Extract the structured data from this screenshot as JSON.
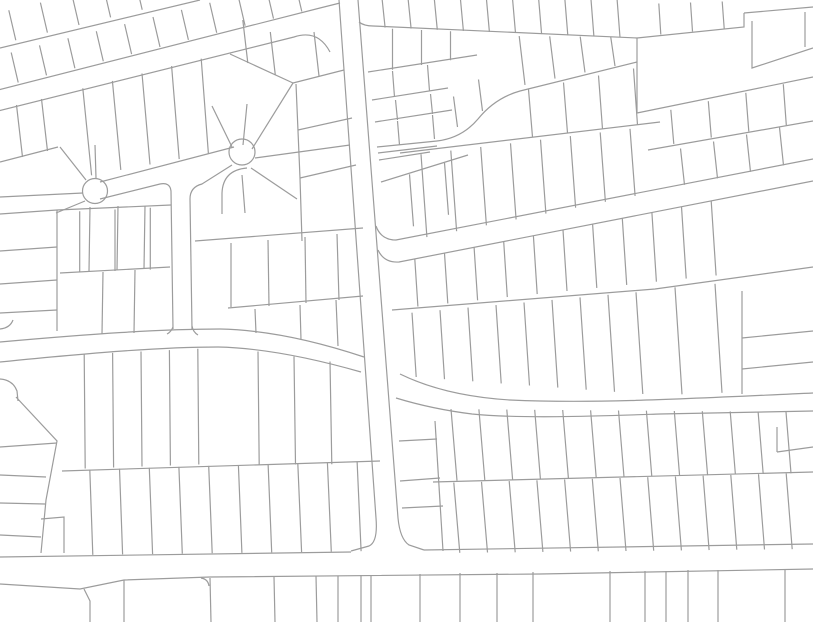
{
  "meta": {
    "description": "Cadastral parcel map viewport: white background with thin gray lot and street lines, cul-de-sac with two bulbs upper left, tilted vertical road in center, curving east-west road mid-left, diagonal roads upper-left and right, horizontal road along the bottom",
    "canvas": {
      "width": 813,
      "height": 622
    },
    "background": "#ffffff",
    "stroke": {
      "color": "#9c9c9c",
      "width": 1.2
    }
  },
  "map": {
    "circles": [
      {
        "cx": 95,
        "cy": 191,
        "r": 12.5,
        "name": "cul-de-sac-bulb-west"
      },
      {
        "cx": 242,
        "cy": 152,
        "r": 13,
        "name": "cul-de-sac-bulb-east"
      }
    ],
    "paths": [
      "M -2,90 L 320,8 L 340,3",
      "M -2,111 L 294,37 Q 318,29 330,52",
      "M 339,0 L 376,518 Q 378,542 369,546 L 351,551",
      "M 358,0 L 398,518 Q 400,539 409,545 L 424,550",
      "M 0,557 L 351,552",
      "M 424,550 L 813,544",
      "M 0,584 L 80,589 L 124,580 L 210,577 L 540,574 L 813,569",
      "M 84,589 L 90,601 L 90,622",
      "M 0,342 C 90,334 160,329 220,329 C 270,330 322,343 364,357",
      "M 0,362 C 90,353 160,347 218,347 C 264,348 312,358 361,372",
      "M 0,329 Q 10,328 13,320",
      "M 0,379 Q 13,380 17,391 L 18,401",
      "M 400,374 Q 445,396 510,400 C 600,404 700,398 813,393",
      "M 396,398 Q 432,409 472,414 C 522,419 600,416 660,414 L 813,411",
      "M 376,226 Q 381,240 396,240 L 813,159",
      "M 378,250 Q 384,263 399,262 L 813,181",
      "M 100,182 L 234,147",
      "M 100,199 L 160,184 Q 170,182 171,191 L 173,329",
      "M 192,329 L 190,199 Q 190,187 202,184 L 232,165",
      "M 167,334 Q 171,332 173,327",
      "M 192,326 Q 193,332 198,335",
      "M 247,168 Q 223,170 222,193 L 222,214",
      "M 86,180 L 60,147",
      "M 96,178 L 95,145",
      "M 83,193 L 0,197",
      "M 85,201 L 56,213",
      "M 232,147 L 212,106",
      "M 243,145 L 247,104",
      "M 252,149 L 293,83",
      "M 255,158 L 350,145",
      "M 251,168 L 297,199",
      "M 242,175 L 245,213",
      "M 0,48 L 200,0",
      "M 0,162 L 58,147",
      "M 230,54 L 293,83",
      "M 293,83 L 344,70",
      "M 296,84 L 300,178 L 302,241",
      "M 298,130 L 352,118",
      "M 300,178 L 356,165",
      "M 0,214 L 57,210",
      "M 0,251 L 57,247",
      "M 0,284 L 57,280",
      "M 0,313 L 57,310",
      "M 57,210 L 57,331",
      "M 57,210 L 171,205",
      "M 60,273 L 170,267",
      "M 90,207 L 89,271",
      "M 118,206 L 117,270",
      "M 145,206 L 144,269",
      "M 103,272 L 102,334",
      "M 135,270 L 134,333",
      "M 195,241 L 363,228",
      "M 228,308 L 363,296",
      "M 231,243 L 231,307",
      "M 268,240 L 269,306",
      "M 305,237 L 306,303",
      "M 337,234 L 339,300",
      "M 255,309 L 256,333",
      "M 300,305 L 301,340",
      "M 336,300 L 338,346",
      "M 637,38 L 637,113",
      "M 637,38 L 744,27 L 744,13",
      "M 744,13 L 813,7",
      "M 752,21 L 752,68 L 813,48",
      "M 805,12 L 805,47",
      "M 637,113 L 813,77",
      "M 359,22 Q 364,26 373,26 L 637,38",
      "M 368,72 L 477,55",
      "M 372,100 L 448,88",
      "M 375,122 L 452,110",
      "M 377,147 L 437,141",
      "M 378,153 L 437,146",
      "M 379,160 L 430,152",
      "M 381,182 L 468,155",
      "M 437,141 Q 462,138 478,119 Q 495,98 520,91 L 637,62",
      "M 400,153 L 660,122",
      "M 648,150 L 813,121",
      "M 392,310 L 655,289 L 813,267",
      "M 742,291 L 742,394",
      "M 742,338 L 813,331",
      "M 742,369 L 813,362",
      "M 399,441 L 437,439",
      "M 400,481 L 440,478",
      "M 402,508 L 443,506",
      "M 435,421 L 443,551",
      "M 433,482 L 813,472",
      "M 62,471 L 380,461",
      "M 777,427 L 777,452",
      "M 777,452 L 813,447",
      "M 16,397 Q 45,428 57,441 L 46,500 L 41,553",
      "M 0,447 L 57,443",
      "M 0,475 L 46,477",
      "M 0,503 L 45,504",
      "M 0,535 L 41,537",
      "M 41,519 L 64,517 L 64,553",
      "M 124,580 L 124,622",
      "M 210,578 L 211,622",
      "M 274,577 L 275,622",
      "M 316,576 L 317,622",
      "M 338,576 L 338,622",
      "M 361,575 L 361,622",
      "M 371,575 L 371,622",
      "M 420,574 L 420,622",
      "M 460,573 L 460,622",
      "M 497,573 L 497,622",
      "M 533,572 L 533,622",
      "M 610,571 L 610,622",
      "M 645,571 L 645,622",
      "M 666,571 L 666,622",
      "M 688,570 L 688,622",
      "M 718,570 L 718,622",
      "M 785,569 L 785,622",
      "M 201,578 Q 208,579 209,586"
    ],
    "fans": [
      {
        "x1": 4,
        "y1": 86,
        "x2": 316,
        "y2": 8,
        "n": 11,
        "ex1": -7,
        "ey1": -30,
        "ex2": -7,
        "ey2": -30
      },
      {
        "x1": 0,
        "y1": 44,
        "x2": 158,
        "y2": 6,
        "n": 5,
        "ex1": -7,
        "ey1": -30,
        "ex2": -7,
        "ey2": -30
      },
      {
        "x1": 4,
        "y1": 108,
        "x2": 54,
        "y2": 96,
        "n": 2,
        "ex1": 6,
        "ey1": 52,
        "ex2": 6,
        "ey2": 52
      },
      {
        "x1": 68,
        "y1": 92,
        "x2": 216,
        "y2": 55,
        "n": 5,
        "ex1": 9,
        "ey1": 86,
        "ex2": 7,
        "ey2": 96
      },
      {
        "x1": 234,
        "y1": 57,
        "x2": 289,
        "y2": 81,
        "n": 2,
        "ex1": -5,
        "ey1": -43,
        "ex2": -5,
        "ey2": -43
      },
      {
        "x1": 298,
        "y1": 81,
        "x2": 340,
        "y2": 71,
        "n": 1,
        "ex1": -5,
        "ey1": -44,
        "ex2": -5,
        "ey2": -44
      },
      {
        "x1": 372,
        "y1": 27,
        "x2": 633,
        "y2": 38,
        "n": 10,
        "ex1": -3,
        "ey1": -28,
        "ex2": -3,
        "ey2": -40
      },
      {
        "x1": 378,
        "y1": 28,
        "x2": 465,
        "y2": 32,
        "n": 3,
        "ex1": 0,
        "ey1": 44,
        "ex2": 0,
        "ey2": 26
      },
      {
        "x1": 375,
        "y1": 74,
        "x2": 445,
        "y2": 62,
        "n": 2,
        "ex1": 2,
        "ey1": 26,
        "ex2": 2,
        "ey2": 26
      },
      {
        "x1": 378,
        "y1": 103,
        "x2": 448,
        "y2": 91,
        "n": 2,
        "ex1": 2,
        "ey1": 20,
        "ex2": 2,
        "ey2": 20
      },
      {
        "x1": 380,
        "y1": 124,
        "x2": 450,
        "y2": 112,
        "n": 2,
        "ex1": 2,
        "ey1": 24,
        "ex2": 2,
        "ey2": 24
      },
      {
        "x1": 392,
        "y1": 180,
        "x2": 462,
        "y2": 157,
        "n": 2,
        "ex1": 4,
        "ey1": 52,
        "ex2": 4,
        "ey2": 52
      },
      {
        "x1": 510,
        "y1": 88,
        "x2": 630,
        "y2": 63,
        "n": 4,
        "ex1": -6,
        "ey1": -52,
        "ex2": -4,
        "ey2": -26
      },
      {
        "x1": 445,
        "y1": 135,
        "x2": 495,
        "y2": 103,
        "n": 2,
        "ex1": -4,
        "ey1": -30,
        "ex2": -4,
        "ey2": -32
      },
      {
        "x1": 515,
        "y1": 139,
        "x2": 655,
        "y2": 123,
        "n": 4,
        "ex1": -4,
        "ey1": -46,
        "ex2": -4,
        "ey2": -58
      },
      {
        "x1": 412,
        "y1": 240,
        "x2": 650,
        "y2": 193,
        "n": 8,
        "ex1": -6,
        "ey1": -84,
        "ex2": -5,
        "ey2": -66
      },
      {
        "x1": 655,
        "y1": 147,
        "x2": 805,
        "y2": 122,
        "n": 4,
        "ex1": -3,
        "ey1": -33,
        "ex2": -3,
        "ey2": -42
      },
      {
        "x1": 668,
        "y1": 188,
        "x2": 800,
        "y2": 162,
        "n": 4,
        "ex1": -4,
        "ey1": -36,
        "ex2": -4,
        "ey2": -38
      },
      {
        "x1": 400,
        "y1": 262,
        "x2": 726,
        "y2": 198,
        "n": 11,
        "ex1": 3,
        "ey1": 46,
        "ex2": 5,
        "ey2": 76
      },
      {
        "x1": 398,
        "y1": 314,
        "x2": 650,
        "y2": 291,
        "n": 9,
        "ex1": 4,
        "ey1": 62,
        "ex2": 7,
        "ey2": 104
      },
      {
        "x1": 655,
        "y1": 289,
        "x2": 735,
        "y2": 282,
        "n": 2,
        "ex1": 7,
        "ey1": 106,
        "ex2": 7,
        "ey2": 110
      },
      {
        "x1": 70,
        "y1": 355,
        "x2": 212,
        "y2": 348,
        "n": 5,
        "ex1": 1,
        "ey1": 114,
        "ex2": 1,
        "ey2": 116
      },
      {
        "x1": 240,
        "y1": 349,
        "x2": 348,
        "y2": 364,
        "n": 3,
        "ex1": 1,
        "ey1": 116,
        "ex2": 2,
        "ey2": 100
      },
      {
        "x1": 75,
        "y1": 470,
        "x2": 372,
        "y2": 461,
        "n": 10,
        "ex1": 3,
        "ey1": 85,
        "ex2": 4,
        "ey2": 90
      },
      {
        "x1": 437,
        "y1": 409,
        "x2": 800,
        "y2": 412,
        "n": 13,
        "ex1": 6,
        "ey1": 72,
        "ex2": 5,
        "ey2": 61
      },
      {
        "x1": 440,
        "y1": 483,
        "x2": 800,
        "y2": 473,
        "n": 13,
        "ex1": 6,
        "ey1": 70,
        "ex2": 6,
        "ey2": 76
      },
      {
        "x1": 62,
        "y1": 212,
        "x2": 168,
        "y2": 207,
        "n": 3,
        "ex1": 0,
        "ey1": 61,
        "ex2": 0,
        "ey2": 62
      },
      {
        "x1": 645,
        "y1": 36,
        "x2": 740,
        "y2": 27,
        "n": 3,
        "ex1": -2,
        "ey1": -32,
        "ex2": -2,
        "ey2": -26
      }
    ]
  }
}
